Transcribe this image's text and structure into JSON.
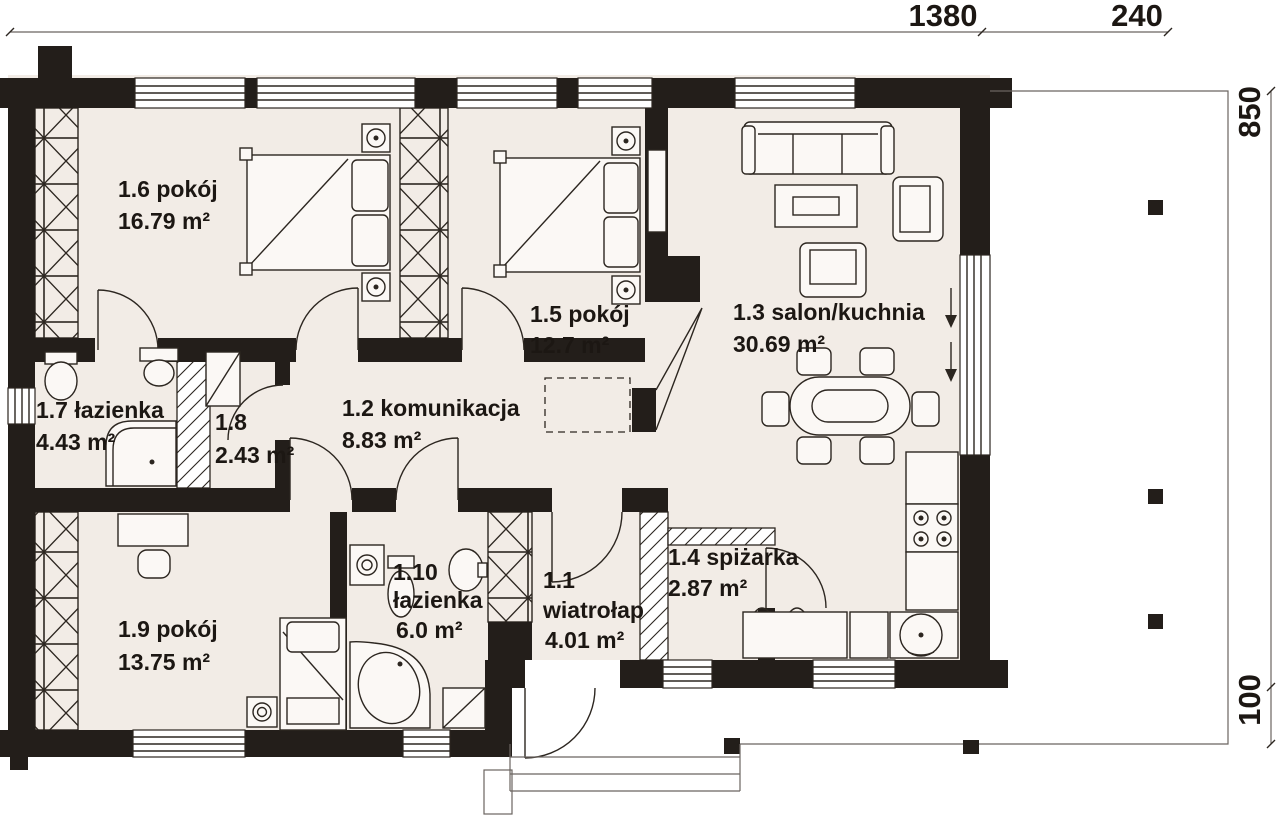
{
  "plan": {
    "colors": {
      "wall": "#231e1a",
      "room_fill": "#f2ece6",
      "line": "#2c2620",
      "paper": "#ffffff"
    },
    "dimensions": {
      "top_main": "1380",
      "top_porch": "240",
      "right_main": "850",
      "right_porch": "100"
    },
    "rooms": {
      "r11": {
        "label": "1.1",
        "name": "wiatrołap",
        "area": "4.01 m²"
      },
      "r12": {
        "label": "1.2 komunikacja",
        "area": "8.83 m²"
      },
      "r13": {
        "label": "1.3 salon/kuchnia",
        "area": "30.69 m²"
      },
      "r14": {
        "label": "1.4 spiżarka",
        "area": "2.87 m²"
      },
      "r15": {
        "label": "1.5 pokój",
        "area": "12.7 m²"
      },
      "r16": {
        "label": "1.6 pokój",
        "area": "16.79 m²"
      },
      "r17": {
        "label": "1.7 łazienka",
        "area": "4.43 m²"
      },
      "r18": {
        "label": "1.8",
        "area": "2.43 m²"
      },
      "r19": {
        "label": "1.9 pokój",
        "area": "13.75 m²"
      },
      "r110": {
        "label": "1.10",
        "name": "łazienka",
        "area": "6.0 m²"
      }
    }
  }
}
